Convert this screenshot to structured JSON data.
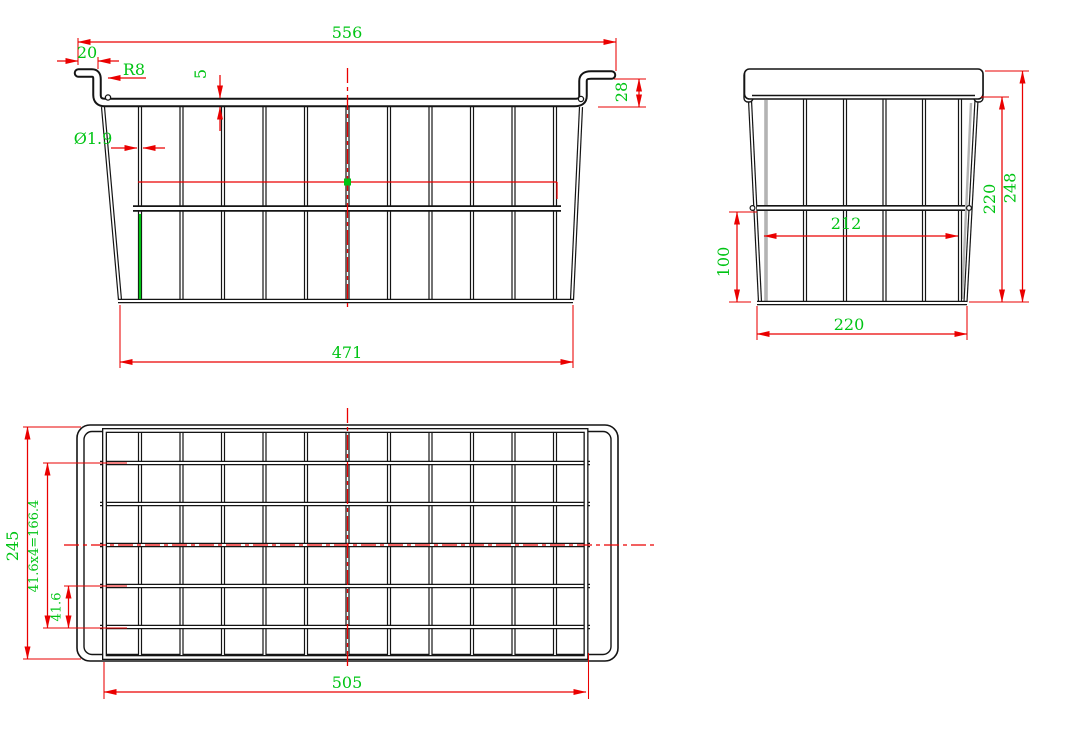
{
  "drawing": {
    "type": "wire-basket engineering drawing, three orthographic views",
    "colors": {
      "geometry": "#141414",
      "dimension_lines": "#ea0000",
      "dimension_text": "#00c414",
      "background": "#ffffff"
    }
  },
  "views": {
    "front": {
      "total_width": "556",
      "hook_length": "20",
      "bend_radius": "R8",
      "rim_thickness": "5",
      "wire_diameter": "Ø1.9",
      "hook_height": "28",
      "bottom_width": "471"
    },
    "side": {
      "wire_length": "212",
      "lower_height": "100",
      "bottom_width": "220",
      "inner_height": "220",
      "overall_height": "248"
    },
    "top": {
      "overall_depth": "245",
      "pitch_equation": "41.6x4=166.4",
      "pitch": "41.6",
      "bottom_length": "505"
    }
  }
}
